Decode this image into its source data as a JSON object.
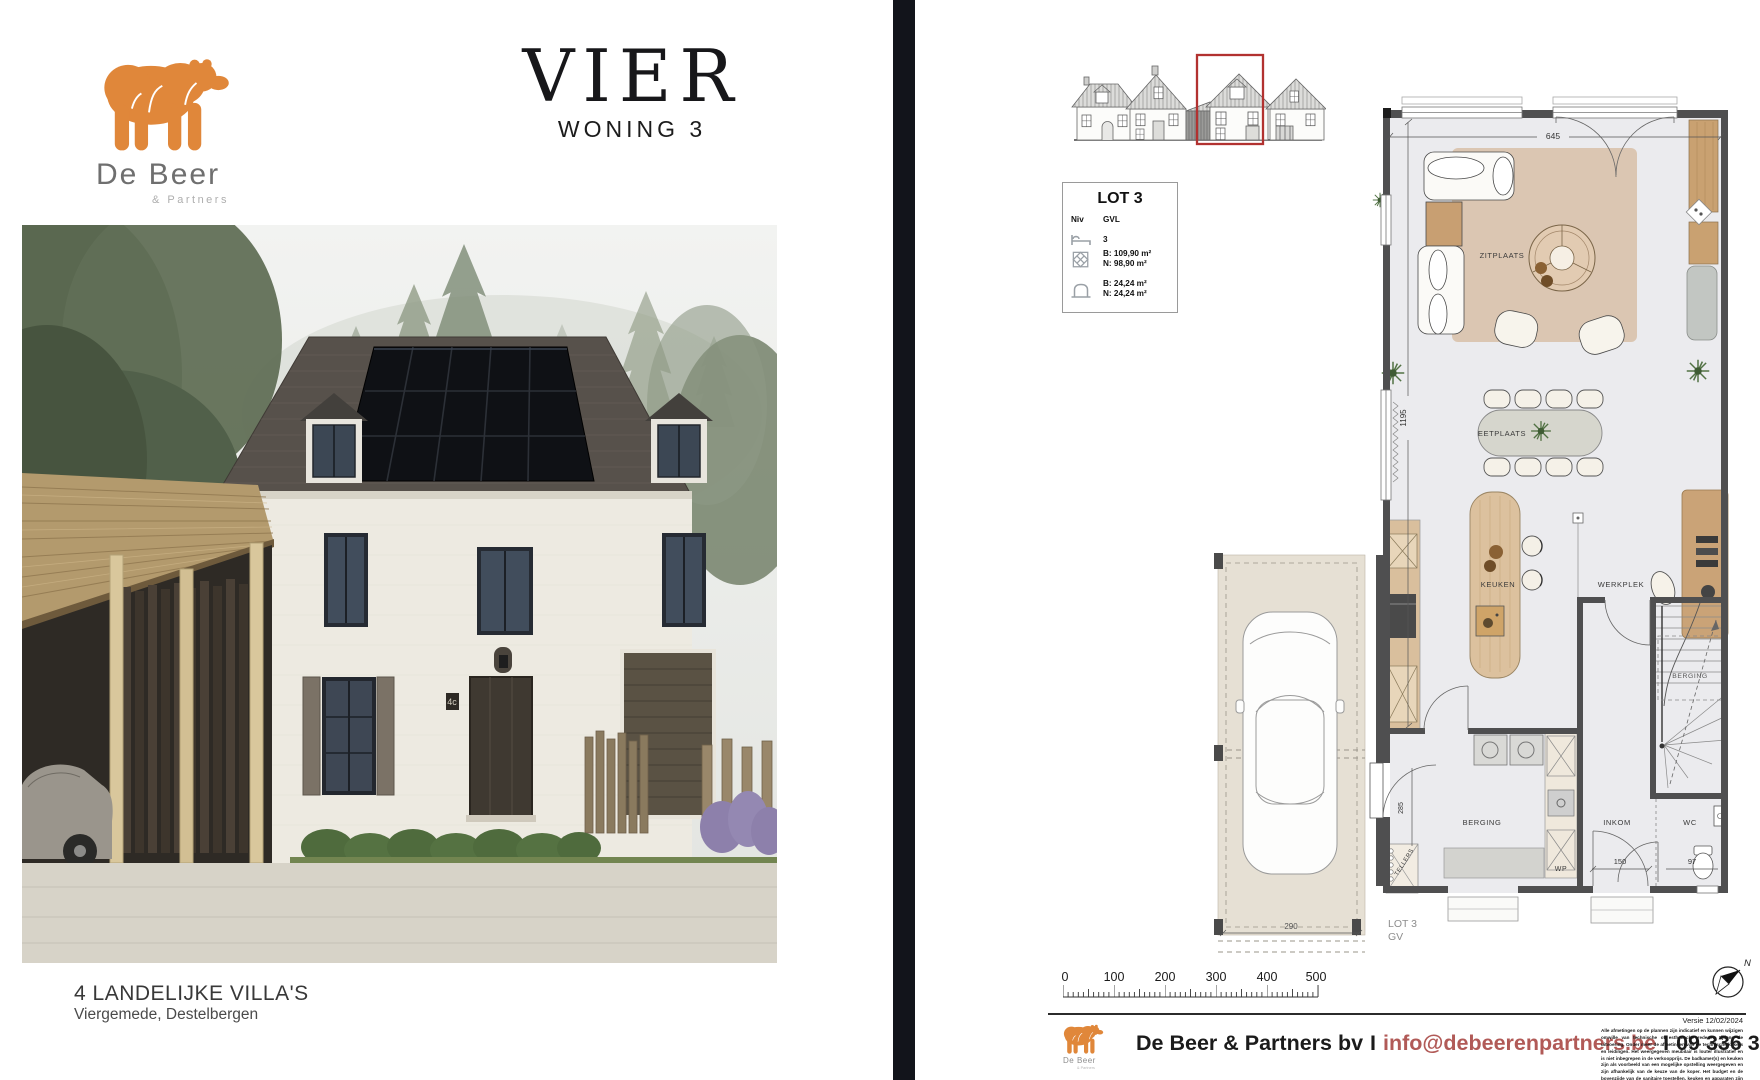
{
  "colors": {
    "bear_orange": "#e0873a",
    "email_link": "#b15a57",
    "elevation_highlight_red": "#b23230",
    "divider_dark": "#12141b"
  },
  "logo": {
    "name": "De Beer",
    "sub": "& Partners"
  },
  "left_page": {
    "title": "VIER",
    "subtitle": "WONING 3",
    "caption_title": "4 LANDELIJKE VILLA'S",
    "caption_sub": "Viergemede, Destelbergen",
    "house_number": "4c"
  },
  "lot_box": {
    "title": "LOT 3",
    "col_niv": "Niv",
    "col_gvl": "GVL",
    "bedrooms": "3",
    "area_b": "B: 109,90 m²",
    "area_n": "N: 98,90 m²",
    "terrace_b": "B: 24,24 m²",
    "terrace_n": "N: 24,24 m²"
  },
  "floorplan": {
    "labels": {
      "zitplaats": "ZITPLAATS",
      "eetplaats": "EETPLAATS",
      "keuken": "KEUKEN",
      "werkplek": "WERKPLEK",
      "berging_stairs": "BERGING",
      "berging": "BERGING",
      "inkom": "INKOM",
      "wc": "WC",
      "wp": "WP",
      "tellers": "TELLERS",
      "lot": "LOT 3",
      "level": "GV"
    },
    "dims": {
      "top_width": "645",
      "left_height": "1195",
      "carport_width": "290",
      "inkom_width": "150",
      "wc_width": "97",
      "door_left": "285"
    }
  },
  "scalebar": {
    "ticks": [
      "0",
      "100",
      "200",
      "300",
      "400",
      "500"
    ]
  },
  "compass": {
    "north": "N"
  },
  "footer": {
    "company": "De Beer & Partners bv",
    "sep1": "I",
    "email": "info@debeerenpartners.be",
    "sep2": "I",
    "phone": "09 336 33 30"
  },
  "fineprint": {
    "version": "Versie 12/02/2024",
    "text": "Alle afmetingen op de plannen zijn indicatief en kunnen wijzigen omwille van technische of esthetische redenen tijdens de uitvoering. Onder meer de afmetingen van de technische kokers en leidingen. Het weergegeven meubilair is louter illustratief en is niet inbegrepen in de verkoopprijs. De badkamer(s) en keuken zijn als voorbeeld van een mogelijke opstelling weergegeven en zijn afhankelijk van de keuze van de koper. Het budget en de bovenzijde van de sanitaire toestellen, keuken en apparaten zijn terug te vinden in het verkoopslastenboek."
  }
}
